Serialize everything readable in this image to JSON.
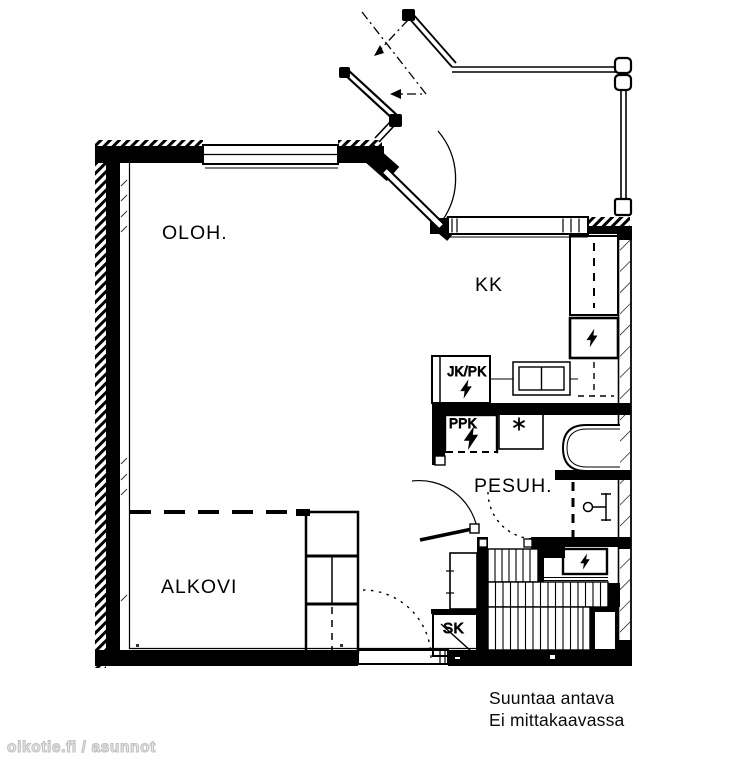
{
  "floorplan": {
    "rooms": {
      "living": "OLOH.",
      "kitchenette": "KK",
      "washroom": "PESUH.",
      "alcove": "ALKOVI"
    },
    "fixtures": {
      "fridge_freezer": "JK/PK",
      "washing_machine": "PPK",
      "cleaning_closet": "SK"
    },
    "icons": {
      "electric_appliance": "lightning-bolt-icon",
      "drain": "asterisk-icon",
      "shower": "shower-fitting-icon"
    },
    "notes": {
      "line1": "Suuntaa antava",
      "line2": "Ei mittakaavassa"
    },
    "watermark": "oikotie.fi / asunnot",
    "colors": {
      "ink": "#000000",
      "paper": "#ffffff",
      "watermark": "#c9c9c9"
    }
  }
}
